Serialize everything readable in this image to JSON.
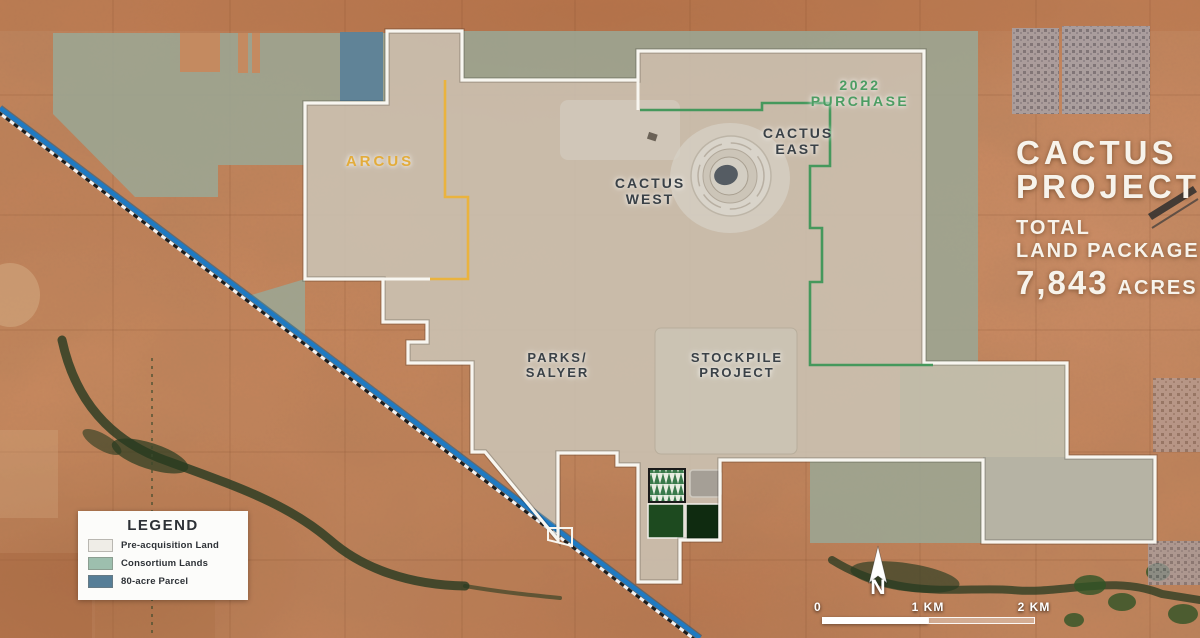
{
  "map": {
    "labels": {
      "arcus": {
        "text": "ARCUS",
        "color": "#e3ac3b"
      },
      "purchase_2022": {
        "text": "2022 PURCHASE",
        "color": "#4c9d63"
      },
      "cactus_west": {
        "line1": "CACTUS",
        "line2": "WEST"
      },
      "cactus_east": {
        "line1": "CACTUS",
        "line2": "EAST"
      },
      "parks_salyer": {
        "line1": "PARKS/",
        "line2": "SALYER"
      },
      "stockpile": {
        "line1": "STOCKPILE",
        "line2": "PROJECT"
      }
    },
    "boundary_colors": {
      "pre_acquisition": "#f8f6f0",
      "arcus": "#eab33e",
      "purchase_2022": "#45985c"
    },
    "railroad_color": "#1f7ac2"
  },
  "title_block": {
    "line1": "CACTUS",
    "line2": "PROJECT",
    "sub1": "TOTAL",
    "sub2": "LAND PACKAGE",
    "acres_number": "7,843",
    "acres_unit": "ACRES"
  },
  "legend": {
    "title": "LEGEND",
    "items": [
      {
        "label": "Pre-acquisition Land",
        "color": "#efede7"
      },
      {
        "label": "Consortium Lands",
        "color": "#9dbfae"
      },
      {
        "label": "80-acre Parcel",
        "color": "#567e97"
      }
    ]
  },
  "scale_bar": {
    "ticks": [
      "0",
      "1 KM",
      "2 KM"
    ]
  },
  "north_indicator": "N"
}
